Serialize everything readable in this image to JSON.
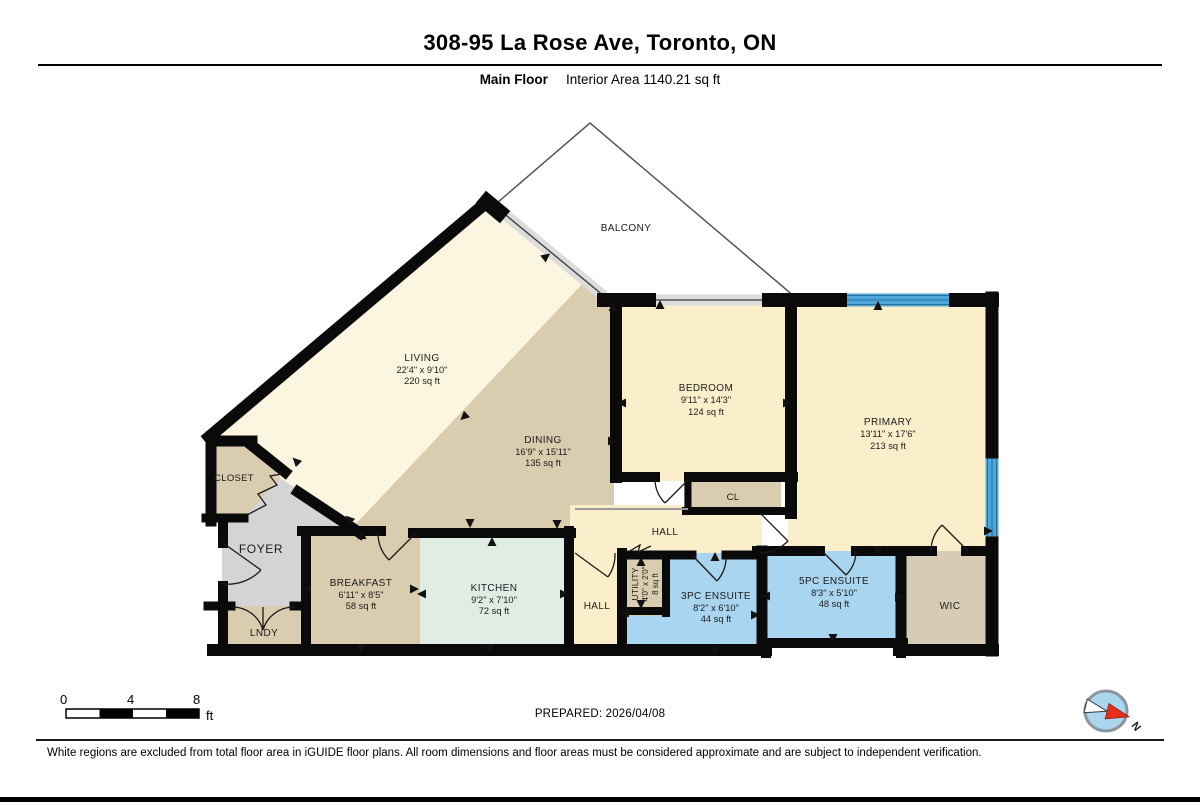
{
  "page": {
    "title": "308-95 La Rose Ave, Toronto, ON",
    "floor_label": "Main Floor",
    "interior_area": "Interior Area 1140.21 sq ft",
    "prepared": "PREPARED: 2026/04/08",
    "disclaimer": "White regions are excluded from total floor area in iGUIDE floor plans. All room dimensions and floor areas must be considered approximate and are subject to independent verification.",
    "scale_bar": {
      "tick_0": "0",
      "tick_4": "4",
      "tick_8": "8",
      "unit": "ft"
    },
    "compass_label": "N"
  },
  "rooms": {
    "balcony": {
      "name": "BALCONY"
    },
    "living": {
      "name": "LIVING",
      "dims": "22'4\" x 9'10\"",
      "area": "220 sq ft"
    },
    "dining": {
      "name": "DINING",
      "dims": "16'9\" x 15'11\"",
      "area": "135 sq ft"
    },
    "bedroom": {
      "name": "BEDROOM",
      "dims": "9'11\" x 14'3\"",
      "area": "124 sq ft"
    },
    "primary": {
      "name": "PRIMARY",
      "dims": "13'11\" x 17'6\"",
      "area": "213 sq ft"
    },
    "closet": {
      "name": "CLOSET"
    },
    "foyer": {
      "name": "FOYER"
    },
    "lndy": {
      "name": "LNDY"
    },
    "breakfast": {
      "name": "BREAKFAST",
      "dims": "6'11\" x 8'5\"",
      "area": "58 sq ft"
    },
    "kitchen": {
      "name": "KITCHEN",
      "dims": "9'2\" x 7'10\"",
      "area": "72 sq ft"
    },
    "hall_upper": {
      "name": "HALL"
    },
    "hall_lower": {
      "name": "HALL"
    },
    "utility": {
      "name": "UTILITY",
      "dims": "4'0\" x 2'0\"",
      "area": "8 sq ft"
    },
    "ensuite_3pc": {
      "name": "3PC ENSUITE",
      "dims": "8'2\" x 6'10\"",
      "area": "44 sq ft"
    },
    "ensuite_5pc": {
      "name": "5PC ENSUITE",
      "dims": "8'3\" x 5'10\"",
      "area": "48 sq ft"
    },
    "wic": {
      "name": "WIC"
    },
    "cl": {
      "name": "CL"
    }
  },
  "colors": {
    "cream_light": "#FCF6E0",
    "cream": "#FBEFCB",
    "tan": "#DACCAE",
    "tan_muted": "#D6CBB4",
    "mint": "#DFEDE4",
    "room_blue": "#A9D5F1",
    "foyer_gray": "#D4D4D6",
    "window_blue": "#4DA6D9",
    "wall_black": "#0A0A0A"
  }
}
